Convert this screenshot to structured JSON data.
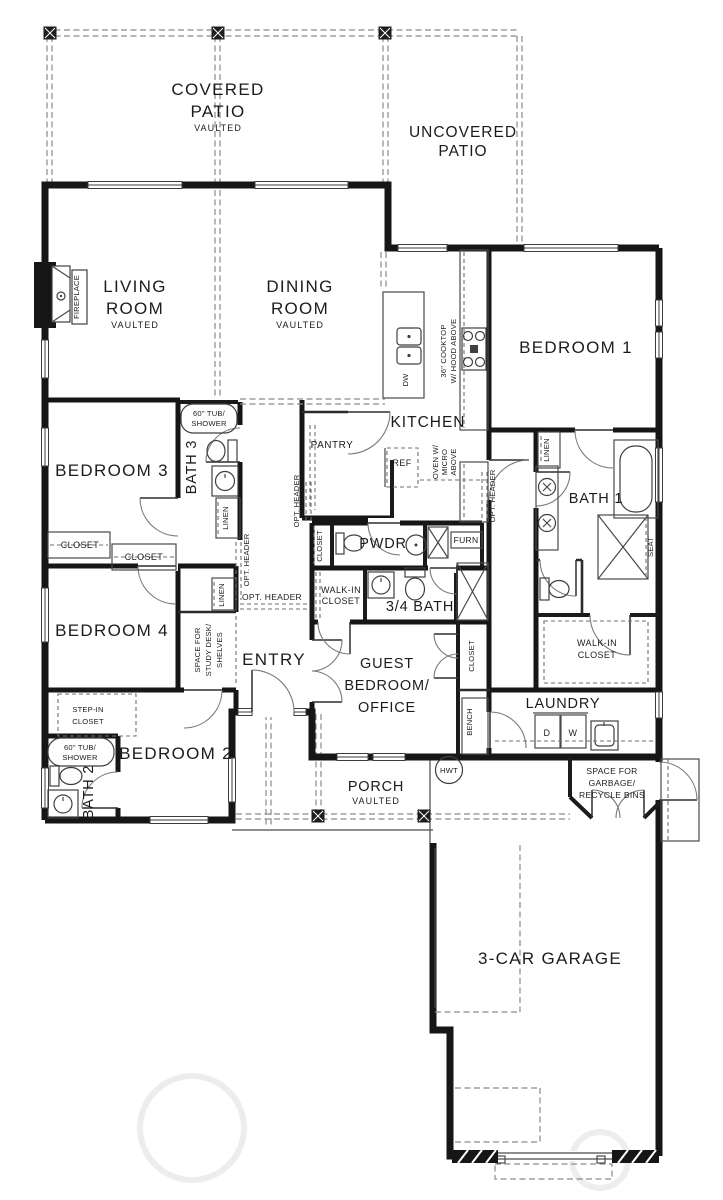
{
  "colors": {
    "wall": "#161616",
    "thin_line": "#4a4a4a",
    "dashed_line": "#8a8a8a",
    "text": "#1c1c1c",
    "background": "#ffffff"
  },
  "rooms": {
    "covered_patio": {
      "line1": "COVERED",
      "line2": "PATIO",
      "ceiling": "VAULTED"
    },
    "uncovered_patio": {
      "line1": "UNCOVERED",
      "line2": "PATIO"
    },
    "living_room": {
      "line1": "LIVING",
      "line2": "ROOM",
      "ceiling": "VAULTED"
    },
    "dining_room": {
      "line1": "DINING",
      "line2": "ROOM",
      "ceiling": "VAULTED"
    },
    "kitchen": {
      "name": "KITCHEN"
    },
    "pantry": {
      "name": "PANTRY"
    },
    "entry": {
      "name": "ENTRY"
    },
    "bedroom_1": {
      "name": "BEDROOM 1"
    },
    "bedroom_2": {
      "name": "BEDROOM 2"
    },
    "bedroom_3": {
      "name": "BEDROOM 3"
    },
    "bedroom_4": {
      "name": "BEDROOM 4"
    },
    "guest_bedroom": {
      "line1": "GUEST",
      "line2": "BEDROOM/",
      "line3": "OFFICE"
    },
    "bath_1": {
      "name": "BATH 1"
    },
    "bath_2": {
      "name": "BATH 2"
    },
    "bath_3": {
      "name": "BATH 3"
    },
    "three_quarter_bath": {
      "name": "3/4 BATH"
    },
    "powder_room": {
      "name": "PWDR"
    },
    "laundry": {
      "name": "LAUNDRY"
    },
    "porch": {
      "name": "PORCH",
      "ceiling": "VAULTED"
    },
    "garage": {
      "name": "3-CAR GARAGE"
    },
    "walk_in_closet_guest": {
      "line1": "WALK-IN",
      "line2": "CLOSET"
    },
    "walk_in_closet_main": {
      "line1": "WALK-IN",
      "line2": "CLOSET"
    },
    "study_niche": {
      "line1": "SPACE FOR",
      "line2": "STUDY DESK/",
      "line3": "SHELVES"
    },
    "step_in_closet": {
      "line1": "STEP-IN",
      "line2": "CLOSET"
    },
    "garbage_space": {
      "line1": "SPACE FOR",
      "line2": "GARBAGE/",
      "line3": "RECYCLE BINS"
    }
  },
  "closets": {
    "bedroom3_a": "CLOSET",
    "bedroom3_b": "CLOSET",
    "coat": "CLOSET",
    "guest_hall": "CLOSET"
  },
  "linen": {
    "bath3": "LINEN",
    "entry": "LINEN",
    "bath1": "LINEN"
  },
  "opt_headers": {
    "h1": "OPT. HEADER",
    "h2": "OPT. HEADER",
    "h3": "OPT. HEADER",
    "h4": "OPT. HEADER"
  },
  "fixtures": {
    "fireplace": "FIREPLACE",
    "cooktop_line1": "36\" COOKTOP",
    "cooktop_line2": "W/ HOOD ABOVE",
    "oven_line1": "OVEN W/",
    "oven_line2": "MICRO",
    "oven_line3": "ABOVE",
    "dishwasher": "DW",
    "refrigerator": "REF",
    "bath3_tub_line1": "60\" TUB/",
    "bath3_tub_line2": "SHOWER",
    "bath2_tub_line1": "60\" TUB/",
    "bath2_tub_line2": "SHOWER",
    "dryer": "D",
    "washer": "W",
    "water_heater": "HWT",
    "furnace": "FURN",
    "shower_seat": "SEAT",
    "bench": "BENCH"
  }
}
